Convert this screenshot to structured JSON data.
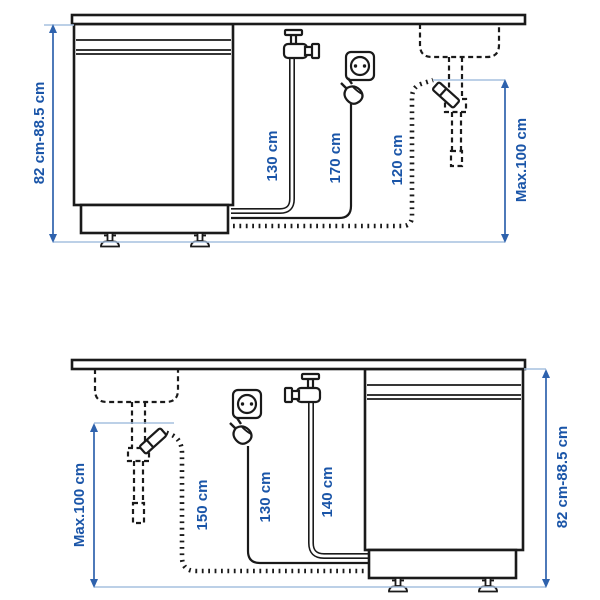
{
  "page": {
    "background": "#ffffff",
    "description_labels_only": true
  },
  "colors": {
    "diagram_line": "#1a1a1a",
    "dimension_line": "#2e62ad",
    "dimension_text": "#1a55a8",
    "light_tick": "#a6c0df"
  },
  "top_diagram": {
    "layout": "dishwasher-left-sink-right",
    "measurements": {
      "cabinet_height": "82 cm-88.5 cm",
      "water_supply_hose": "130 cm",
      "power_cord": "170 cm",
      "drain_hose": "120 cm",
      "max_drain_height": "Max.100 cm"
    }
  },
  "bottom_diagram": {
    "layout": "sink-left-dishwasher-right",
    "measurements": {
      "max_drain_height": "Max.100 cm",
      "drain_hose": "150 cm",
      "power_cord": "130 cm",
      "water_supply_hose": "140 cm",
      "cabinet_height": "82 cm-88.5 cm"
    }
  }
}
